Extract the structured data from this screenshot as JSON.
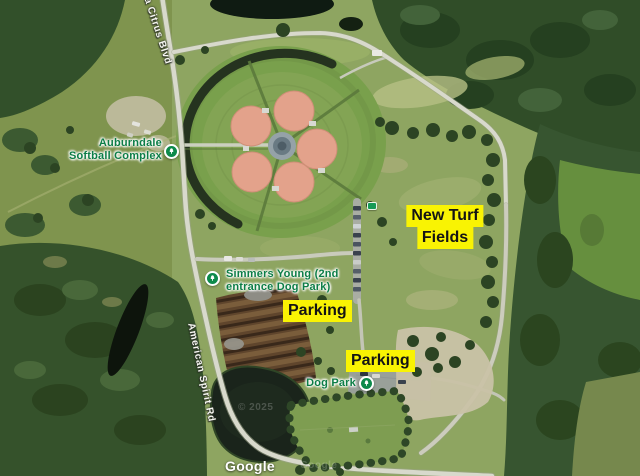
{
  "map": {
    "view": "satellite",
    "logo": "Google",
    "watermarks": {
      "copyright": "© 2025",
      "ghost": "Google"
    },
    "poi": {
      "softball_complex": {
        "line1": "Auburndale",
        "line2": "Softball Complex"
      },
      "simmers_young": {
        "line1": "Simmers Young (2nd",
        "line2": "entrance Dog Park)"
      },
      "dog_park": {
        "label": "Dog Park"
      }
    },
    "roads": {
      "citrus_blvd": "da Citrus Blvd",
      "american_spirit_rd": "American Spirit Rd"
    },
    "annotations": {
      "new_turf": {
        "line1": "New Turf",
        "line2": "Fields"
      },
      "parking_north": "Parking",
      "parking_south": "Parking"
    },
    "colors": {
      "annotation_highlight": "#f9f303",
      "annotation_text": "#141414",
      "poi_label_green": "#0c7d46",
      "road_label_white": "#f6f6f1",
      "infield_clay": "#e3a28b",
      "water": "#1a241b",
      "forest": "#33502a"
    }
  }
}
